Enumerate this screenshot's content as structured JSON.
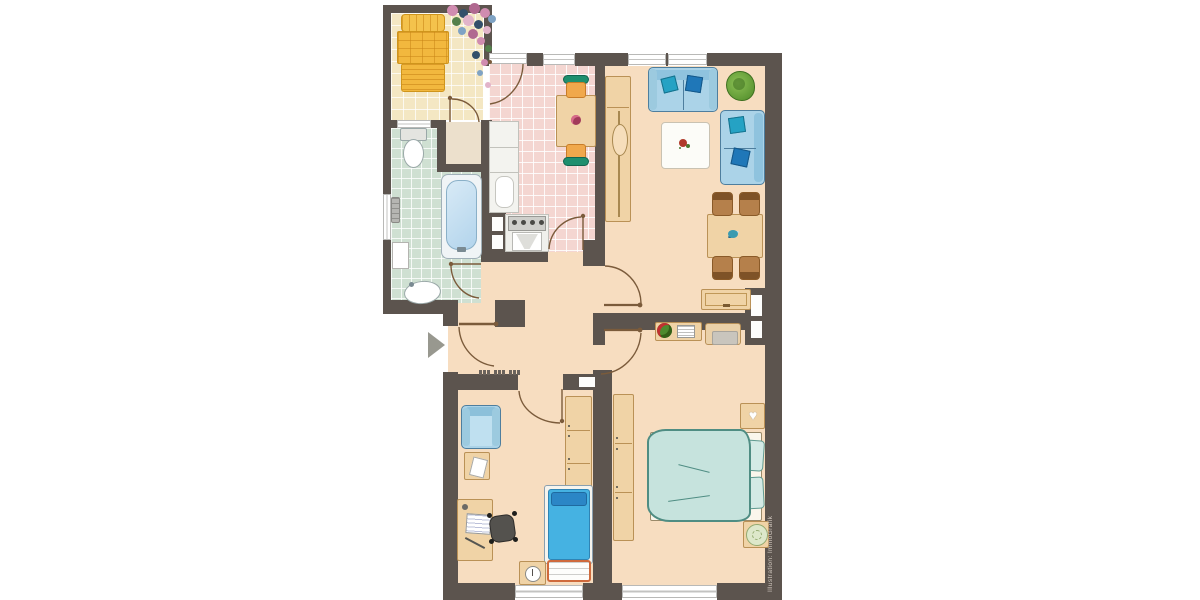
{
  "credit": "Illustration: ImmoGrafik",
  "palette": {
    "wall": "#5c544e",
    "floor_main": "#f7ddc0",
    "floor_kitchen": "#f4d6d1",
    "floor_bathroom": "#cfe0d2",
    "floor_balcony": "#f4e7c3",
    "wood": "#f0d3a6",
    "wood_border": "#ba9156",
    "sofa_blue": "#abd3e8",
    "pillow_teal": "#25a2c4",
    "pillow_blue": "#1f77b8",
    "bed_duvet": "#c6e3dd",
    "kids_bed_blue": "#45b2e2",
    "lounger_orange": "#f2b83e",
    "door_arc": "#7b5b3b",
    "entrance_arrow": "#98988f"
  },
  "rooms": [
    {
      "id": "balcony",
      "floor": "cream-tiles"
    },
    {
      "id": "kitchen",
      "floor": "pink-tiles"
    },
    {
      "id": "bathroom",
      "floor": "green-tiles"
    },
    {
      "id": "storage-closet",
      "floor": "plain"
    },
    {
      "id": "hallway",
      "floor": "plain"
    },
    {
      "id": "living-room",
      "floor": "plain"
    },
    {
      "id": "master-bedroom",
      "floor": "plain"
    },
    {
      "id": "kids-room",
      "floor": "plain"
    }
  ],
  "furniture": {
    "balcony": [
      "sun-lounger",
      "flower-plants"
    ],
    "kitchen": [
      "counter",
      "tall-cabinet",
      "stove",
      "sink",
      "small-dining-table",
      "two-chairs"
    ],
    "bathroom": [
      "toilet",
      "radiator",
      "shelf",
      "bathtub",
      "wash-basin"
    ],
    "living_room": [
      "tall-cabinet",
      "sofa",
      "loveseat",
      "coffee-table",
      "potted-plant",
      "dining-table",
      "four-chairs",
      "sideboard"
    ],
    "master_bedroom": [
      "double-bed",
      "two-nightstands",
      "wardrobe",
      "console-table",
      "bench"
    ],
    "kids_room": [
      "armchair",
      "side-table",
      "desk",
      "desk-chair",
      "single-bed",
      "chest",
      "nightstand-with-clock",
      "wardrobe"
    ]
  },
  "doors": [
    "entrance",
    "bathroom",
    "kitchen",
    "living-room",
    "master-bedroom",
    "kids-room",
    "balcony",
    "balcony-closet"
  ],
  "windows": [
    "bathroom-left",
    "bathroom-to-balcony",
    "kitchen",
    "living-room-1",
    "living-room-2",
    "kids-room",
    "master-bedroom"
  ]
}
